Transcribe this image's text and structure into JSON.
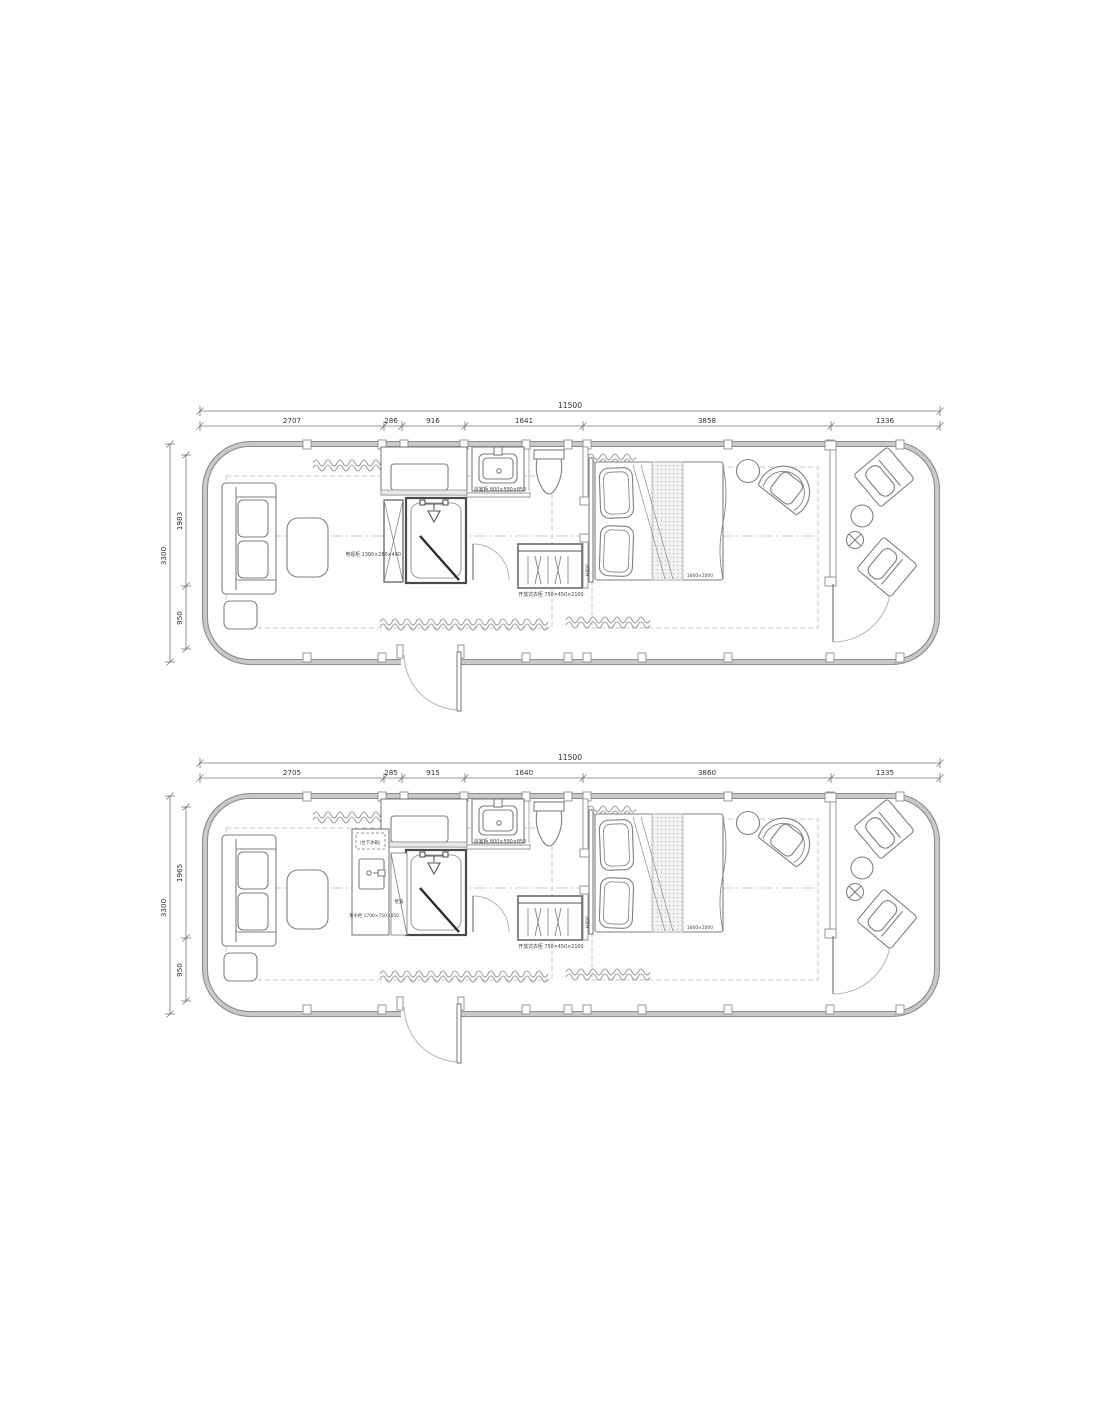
{
  "drawing": {
    "title": "container-house-floor-plans",
    "plan1": {
      "dims_top": {
        "total": "11500",
        "segments": [
          "2707",
          "286",
          "916",
          "1641",
          "3858",
          "1336"
        ]
      },
      "dims_left": {
        "total": "3300",
        "segments": [
          "1983",
          "950"
        ]
      },
      "labels": {
        "tv_cabinet": "电视柜 1300×280×400",
        "vanity": "浴室柜 800×500×850",
        "wardrobe": "开放式衣柜 750×450×2100",
        "bed": "1800×2000",
        "height_note": "H400"
      }
    },
    "plan2": {
      "dims_top": {
        "total": "11500",
        "segments": [
          "2705",
          "285",
          "915",
          "1640",
          "3860",
          "1335"
        ]
      },
      "dims_left": {
        "total": "3300",
        "segments": [
          "1965",
          "950"
        ]
      },
      "labels": {
        "fridge": "(台下冰箱)",
        "tea_cabinet": "茶水柜 1700×750×850",
        "niche": "壁龛",
        "vanity": "浴室柜 800×500×850",
        "wardrobe": "开放式衣柜 750×450×2100",
        "bed": "1800×2000",
        "height_note": "H400"
      }
    },
    "colors": {
      "wall_fill": "#c9c9c9",
      "wall_edge": "#8d8d8d",
      "furniture_line": "#7f7f7f",
      "dim_line": "#777777",
      "dashed_line": "#c8c8c8",
      "text": "#3a3a3a"
    }
  }
}
